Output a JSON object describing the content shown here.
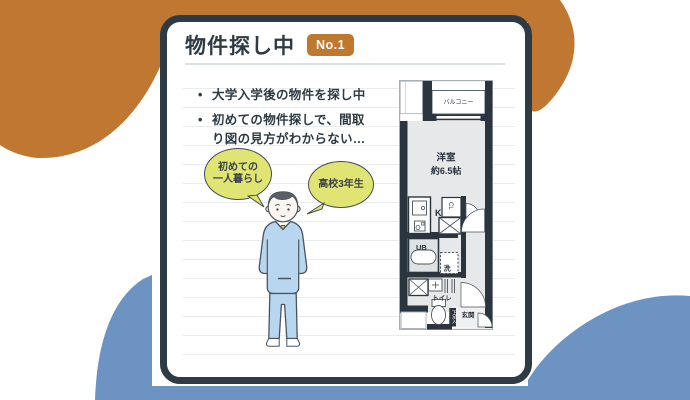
{
  "colors": {
    "accent_orange": "#c0772e",
    "accent_blue": "#6d93c2",
    "navy": "#2e3b44",
    "bubble_yellow": "#e0e472"
  },
  "card": {
    "title": "物件探し中",
    "badge": "No.1",
    "bullet_char": "•",
    "bullets": [
      "大学入学後の物件を探し中",
      "初めての物件探しで、間取り図の見方がわからない…"
    ]
  },
  "bubbles": {
    "first": {
      "line1": "初めての",
      "line2": "一人暮らし"
    },
    "second": {
      "line1": "高校3年生"
    }
  },
  "floorplan": {
    "balcony": "バルコニー",
    "room_name": "洋室",
    "room_size": "約6.5帖",
    "kitchen": "K",
    "closet": "CL",
    "unit_bath": "UB",
    "washer": "洗",
    "toilet": "トイレ",
    "shoe_cabinet": "下足入",
    "entrance": "玄関"
  }
}
